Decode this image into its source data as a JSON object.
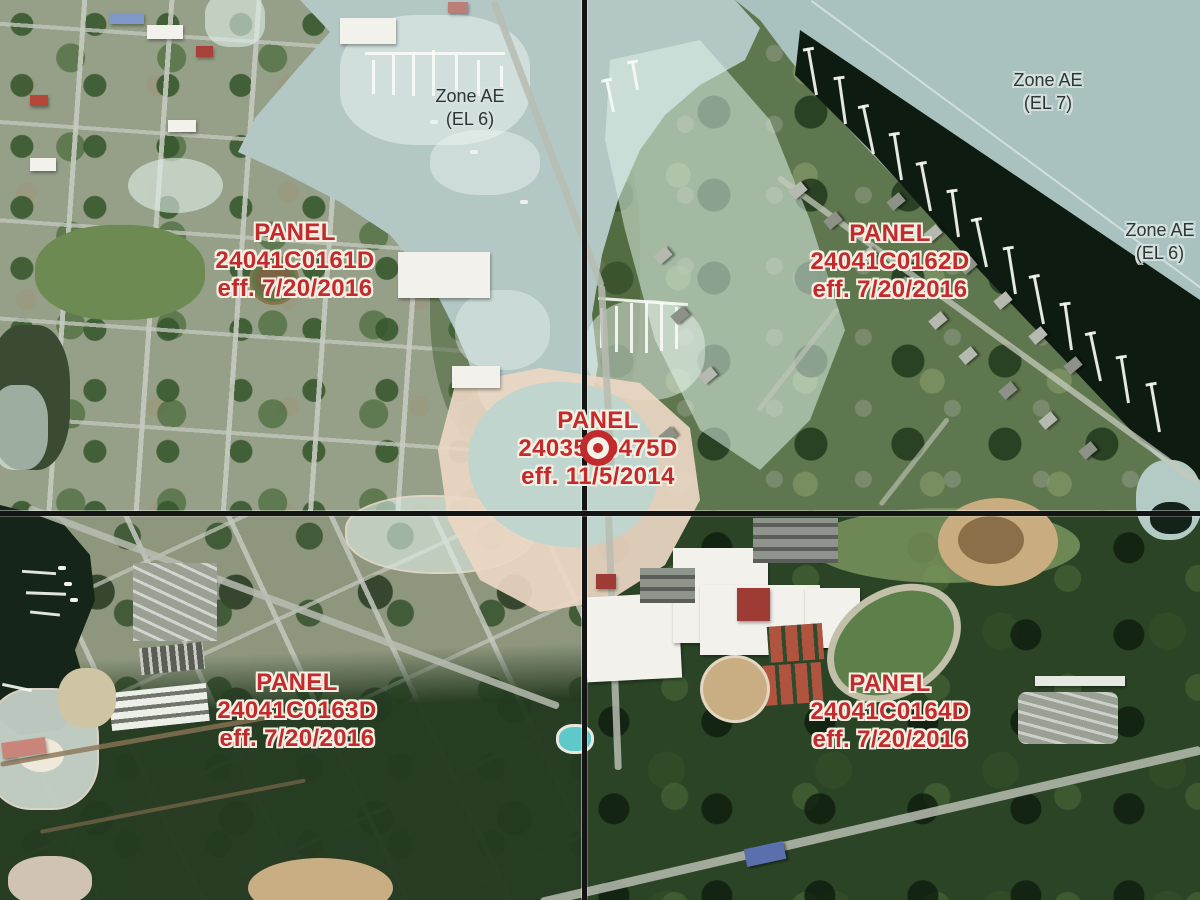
{
  "map_type": "flood-hazard-panel-index-satellite",
  "zone_labels": [
    {
      "id": "zone-harbor",
      "line1": "Zone AE",
      "line2": "(EL 6)"
    },
    {
      "id": "zone-bay",
      "line1": "Zone AE",
      "line2": "(EL 7)"
    },
    {
      "id": "zone-shore",
      "line1": "Zone AE",
      "line2": "(EL 6)"
    }
  ],
  "panel_labels": [
    {
      "id": "panel-0161",
      "heading": "PANEL",
      "number": "24041C0161D",
      "effective": "eff. 7/20/2016"
    },
    {
      "id": "panel-0162",
      "heading": "PANEL",
      "number": "24041C0162D",
      "effective": "eff. 7/20/2016"
    },
    {
      "id": "panel-0475",
      "heading": "PANEL",
      "number": "24035C0475D",
      "effective": "eff. 11/5/2014"
    },
    {
      "id": "panel-0163",
      "heading": "PANEL",
      "number": "24041C0163D",
      "effective": "eff. 7/20/2016"
    },
    {
      "id": "panel-0164",
      "heading": "PANEL",
      "number": "24041C0164D",
      "effective": "eff. 7/20/2016"
    }
  ],
  "marker": {
    "id": "panel-location-marker"
  },
  "colors": {
    "panel_text_red": "#c22a2c",
    "panel_text_halo": "#f3efe3",
    "zone_text_gray": "#2f3638",
    "flood_zone_teal": "#a9c2c0",
    "harbor_teal": "#b3c7c5",
    "flood_overlay_mint": "#e0f0e9",
    "shaded_zone_peach": "#ecd7c3",
    "panel_gridline_black": "#141414",
    "dark_water": "#0d1b10"
  }
}
